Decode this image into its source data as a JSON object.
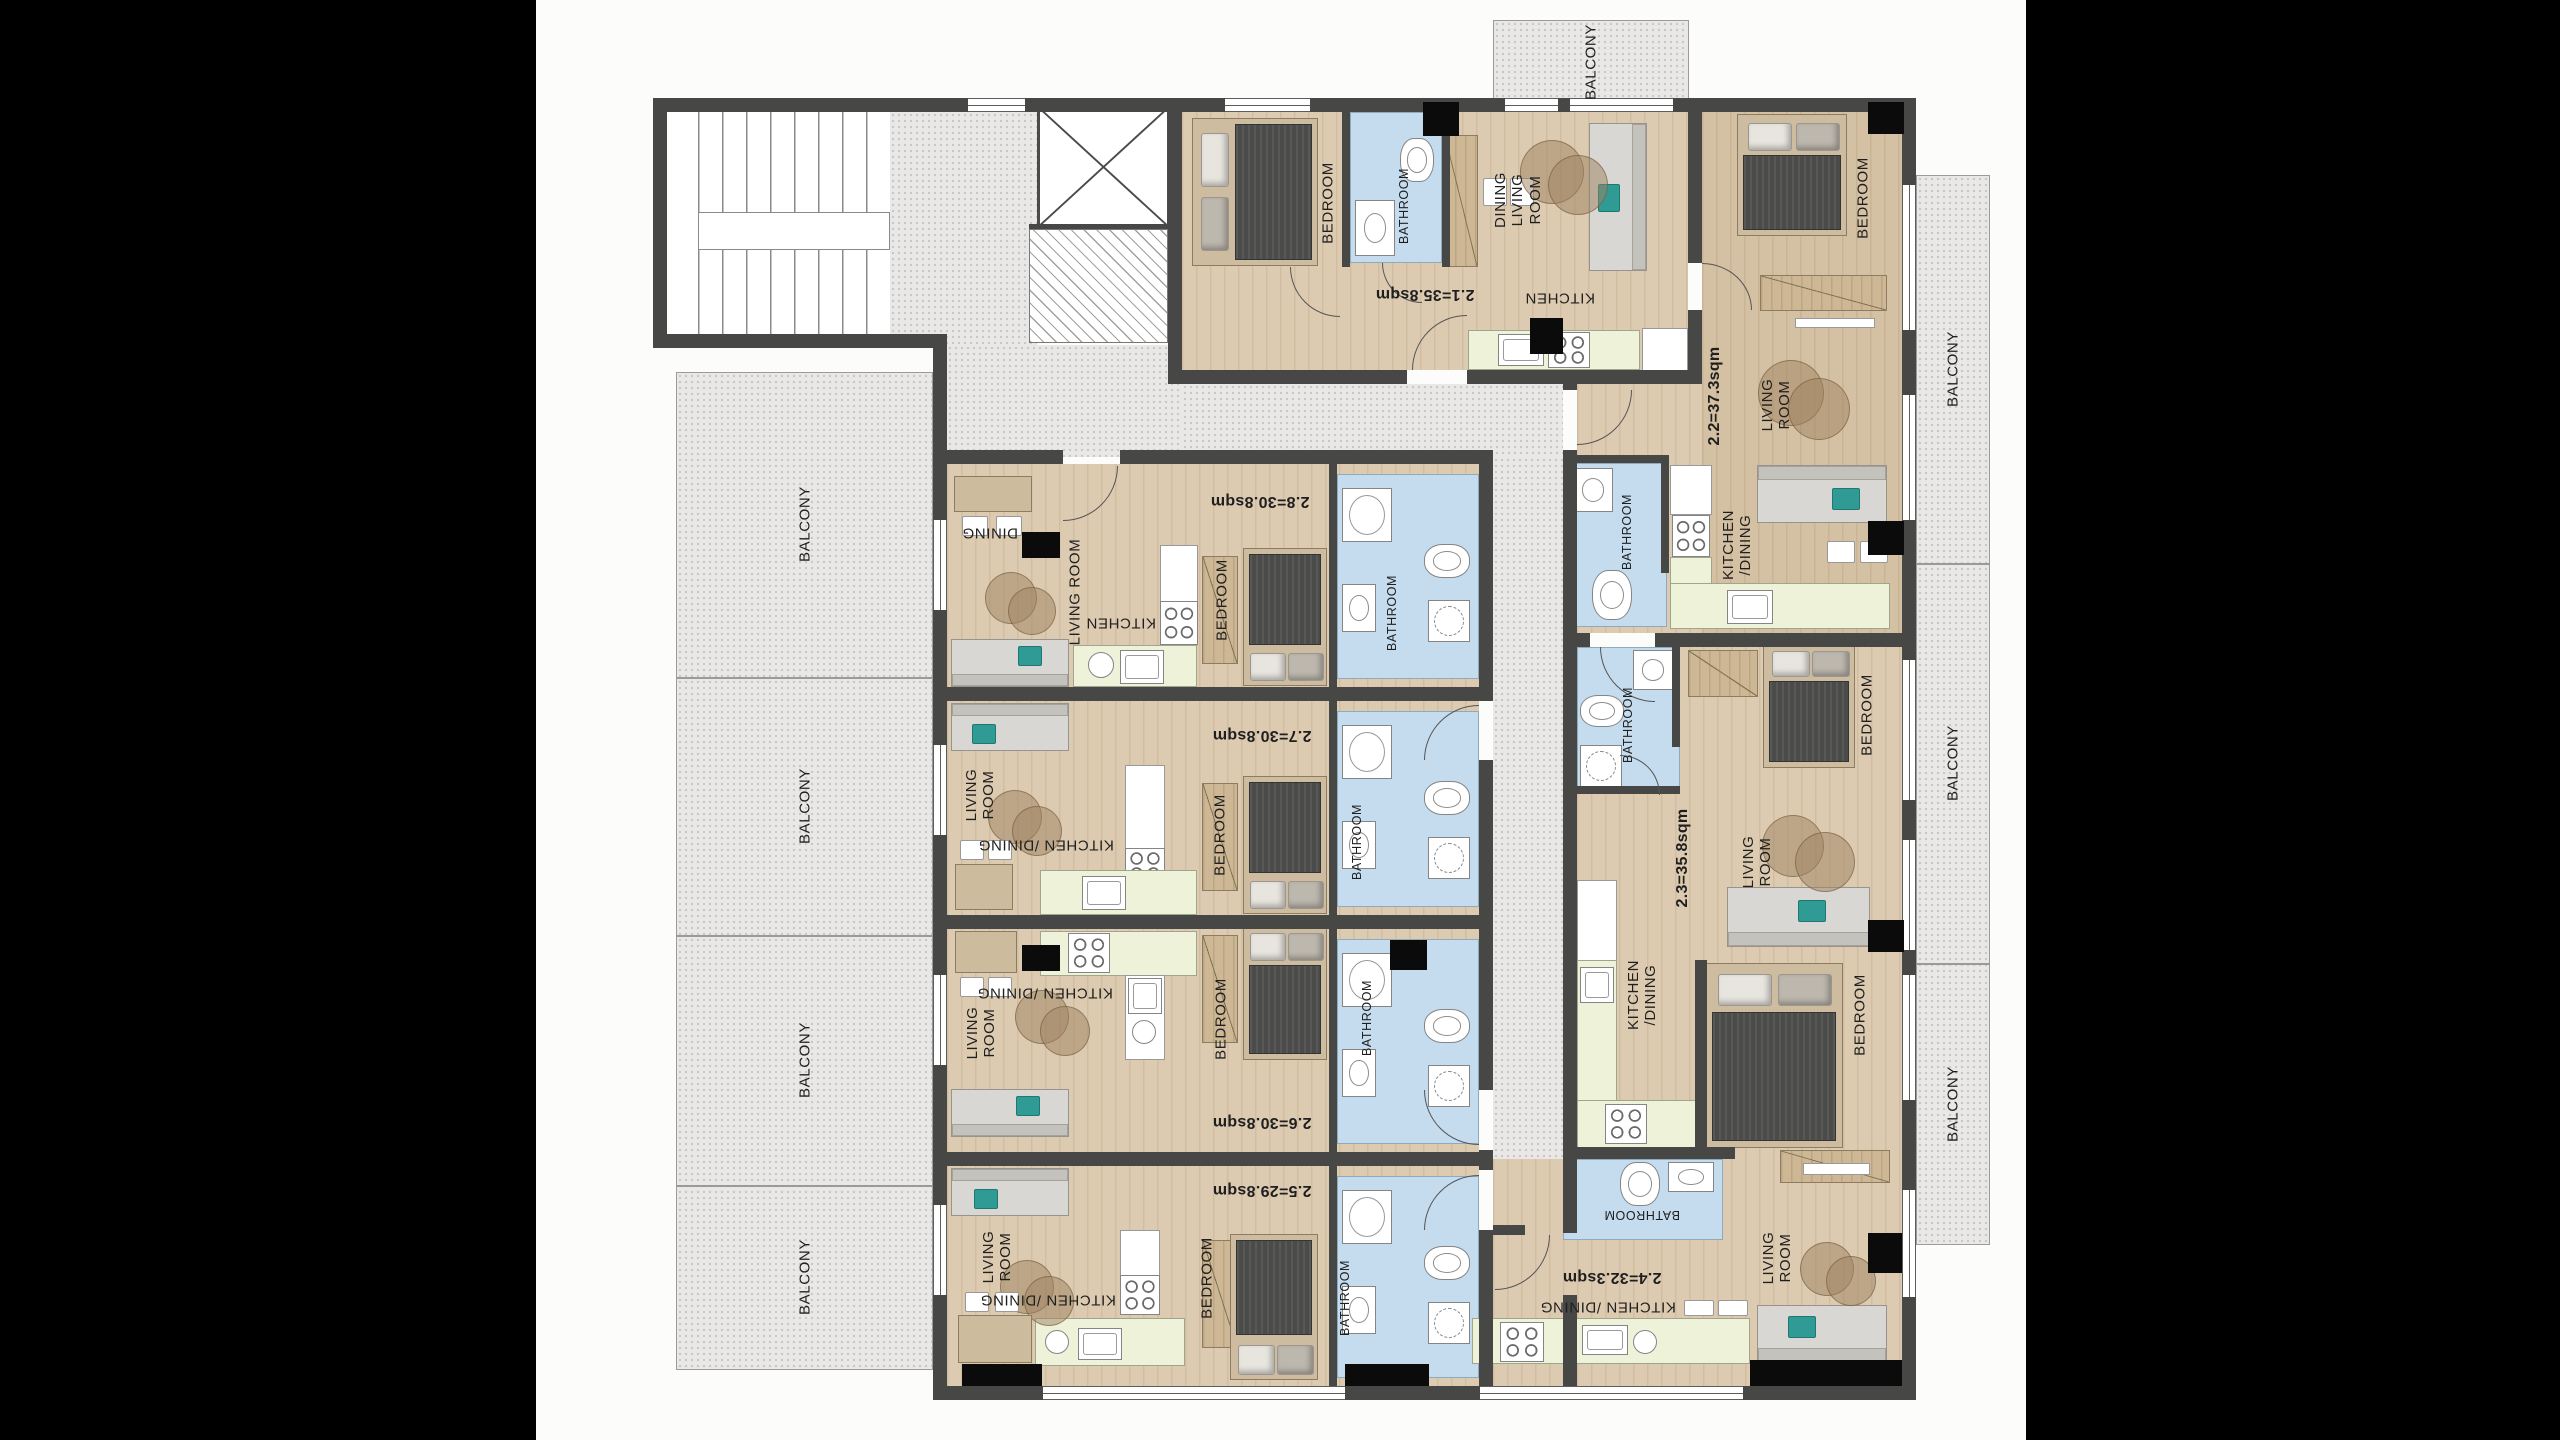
{
  "plan": {
    "balcony_label": "BALCONY",
    "units": [
      {
        "id": "2.1",
        "area": "2.1=35.8sqm",
        "rooms": {
          "bedroom": "BEDROOM",
          "bathroom": "BATHROOM",
          "dining_living": "DINING\nLIVING\nROOM",
          "kitchen": "KITCHEN"
        }
      },
      {
        "id": "2.2",
        "area": "2.2=37.3sqm",
        "rooms": {
          "bedroom": "BEDROOM",
          "living": "LIVING\nROOM",
          "kitchen_dining": "KITCHEN\n/DINING",
          "bathroom": "BATHROOM"
        }
      },
      {
        "id": "2.3",
        "area": "2.3=35.8sqm",
        "rooms": {
          "bathroom": "BATHROOM",
          "bedroom": "BEDROOM",
          "living": "LIVING\nROOM",
          "kitchen_dining": "KITCHEN\n/DINING"
        }
      },
      {
        "id": "2.4",
        "area": "2.4=32.3sqm",
        "rooms": {
          "bathroom": "BATHROOM",
          "kitchen_dining": "KITCHEN /DINING",
          "living": "LIVING\nROOM",
          "bedroom": "BEDROOM"
        }
      },
      {
        "id": "2.5",
        "area": "2.5=29.8sqm",
        "rooms": {
          "living": "LIVING\nROOM",
          "kitchen_dining": "KITCHEN /DINING",
          "bedroom": "BEDROOM",
          "bathroom": "BATHROOM"
        }
      },
      {
        "id": "2.6",
        "area": "2.6=30.8sqm",
        "rooms": {
          "living": "LIVING\nROOM",
          "kitchen_dining": "KITCHEN /DINING",
          "bedroom": "BEDROOM",
          "bathroom": "BATHROOM"
        }
      },
      {
        "id": "2.7",
        "area": "2.7=30.8sqm",
        "rooms": {
          "living": "LIVING\nROOM",
          "kitchen_dining": "KITCHEN /DINING",
          "bedroom": "BEDROOM",
          "bathroom": "BATHROOM"
        }
      },
      {
        "id": "2.8",
        "area": "2.8=30.8sqm",
        "rooms": {
          "dining": "DINING",
          "living": "LIVING ROOM",
          "kitchen": "KITCHEN",
          "bedroom": "BEDROOM",
          "bathroom": "BATHROOM"
        }
      }
    ]
  }
}
